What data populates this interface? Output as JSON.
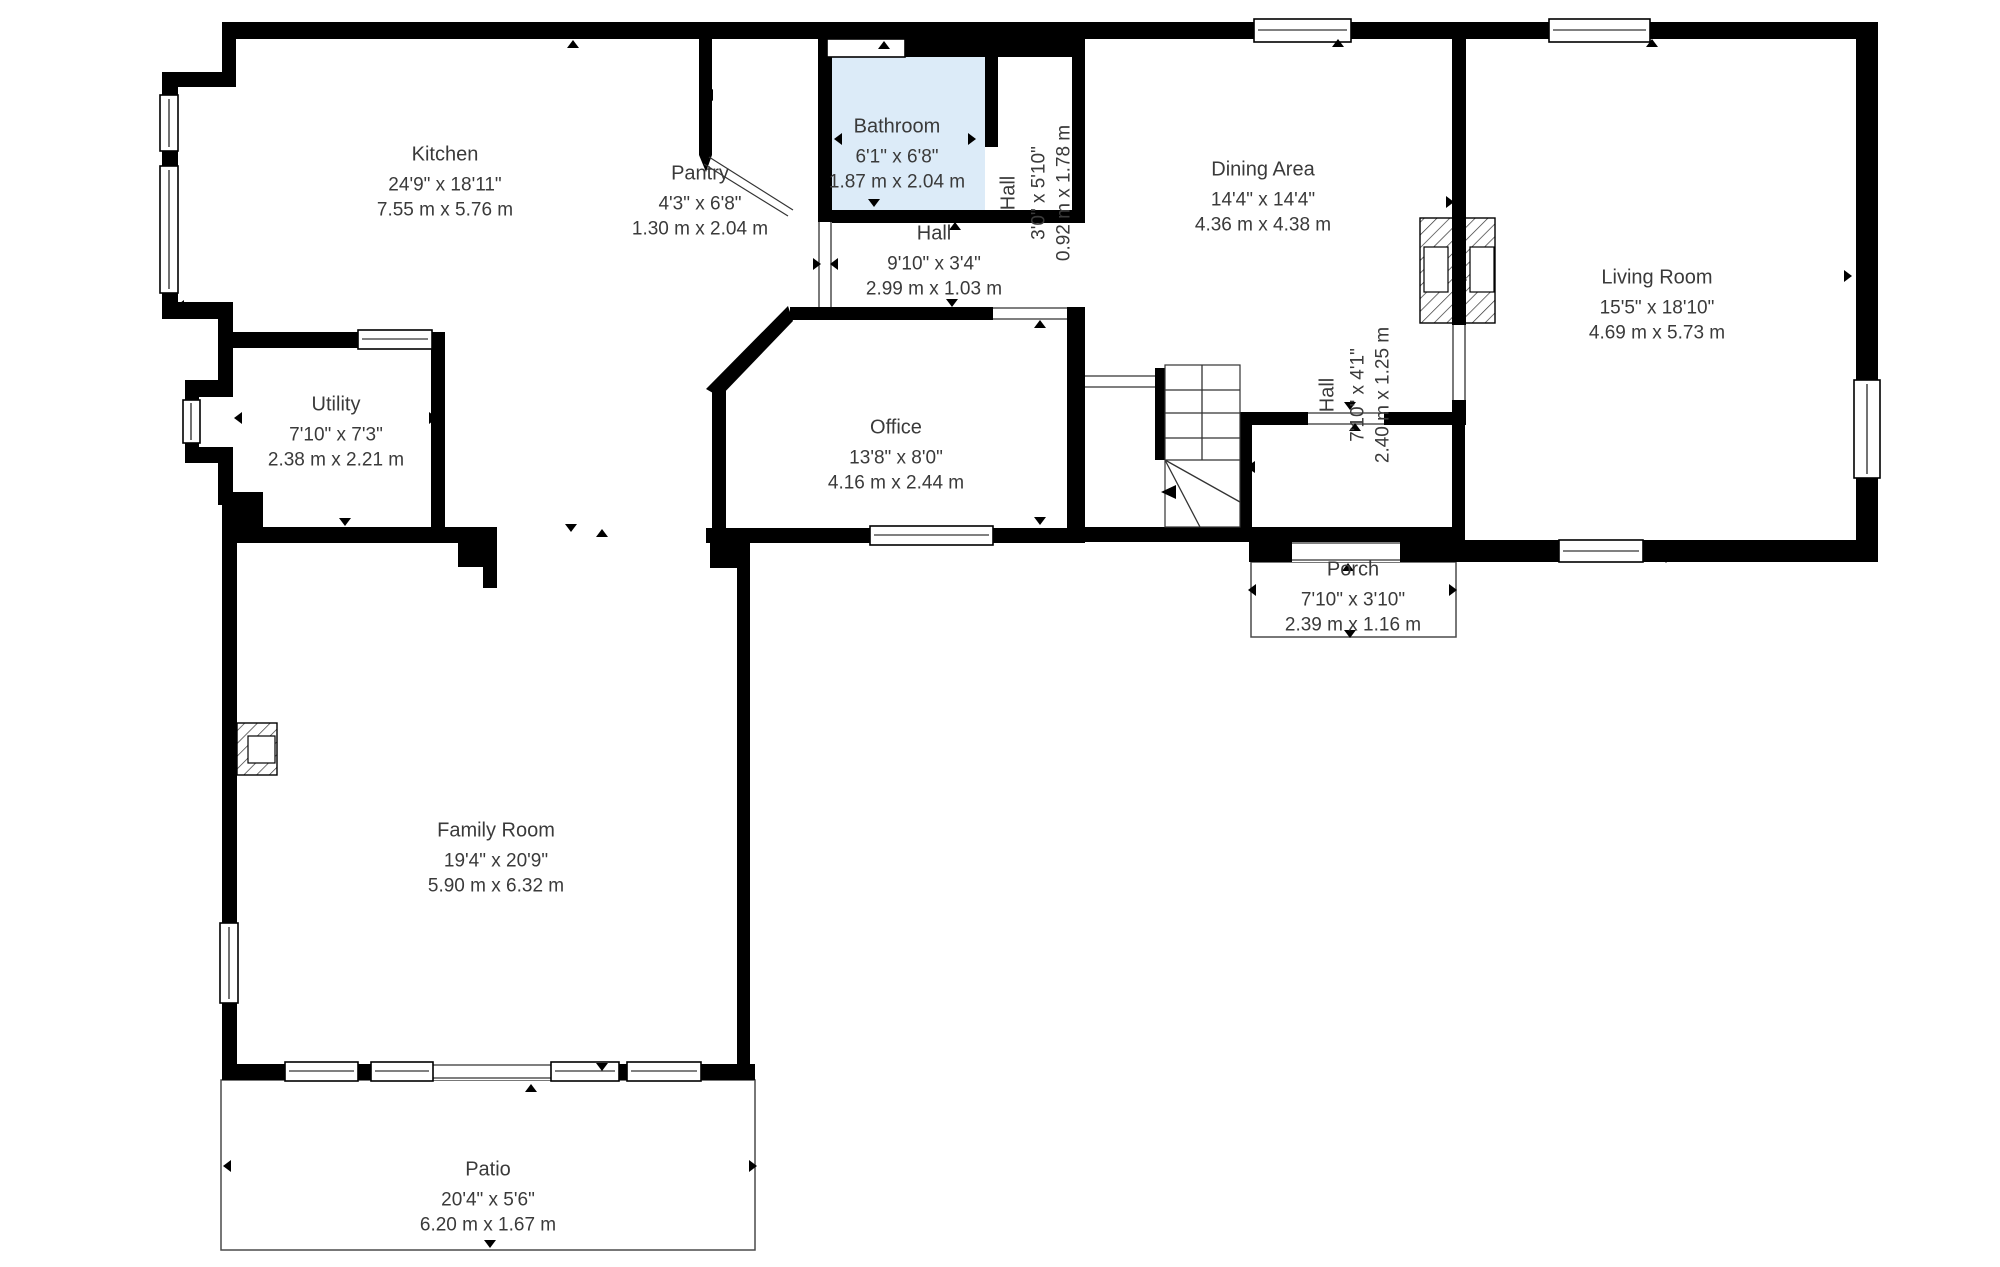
{
  "title": "First floor plan",
  "colors": {
    "wall": "#000000",
    "text": "#3a3a3a",
    "bathroom_fill": "#dcebf8",
    "thin_outline": "#4a4a4a",
    "background": "#ffffff"
  },
  "icons": {
    "door_marker": "small black triangle",
    "window": "white bar with black frame",
    "fireplace": "diagonal-hatched block",
    "staircase": "treads with winders and direction arrow"
  },
  "rooms": [
    {
      "id": "kitchen",
      "name": "Kitchen",
      "imperial": "24'9\" x 18'11\"",
      "metric": "7.55 m x 5.76 m"
    },
    {
      "id": "pantry",
      "name": "Pantry",
      "imperial": "4'3\" x 6'8\"",
      "metric": "1.30 m x 2.04 m"
    },
    {
      "id": "bathroom",
      "name": "Bathroom",
      "imperial": "6'1\" x 6'8\"",
      "metric": "1.87 m x 2.04 m"
    },
    {
      "id": "hall-upper",
      "name": "Hall",
      "imperial": "3'0\" x 5'10\"",
      "metric": "0.92 m x 1.78 m"
    },
    {
      "id": "dining-area",
      "name": "Dining Area",
      "imperial": "14'4\" x 14'4\"",
      "metric": "4.36 m x 4.38 m"
    },
    {
      "id": "living-room",
      "name": "Living Room",
      "imperial": "15'5\" x 18'10\"",
      "metric": "4.69 m x 5.73 m"
    },
    {
      "id": "utility",
      "name": "Utility",
      "imperial": "7'10\" x 7'3\"",
      "metric": "2.38 m x 2.21 m"
    },
    {
      "id": "office",
      "name": "Office",
      "imperial": "13'8\" x 8'0\"",
      "metric": "4.16 m x 2.44 m"
    },
    {
      "id": "hall-middle",
      "name": "Hall",
      "imperial": "9'10\" x 3'4\"",
      "metric": "2.99 m x 1.03 m"
    },
    {
      "id": "hall-stairs",
      "name": "Hall",
      "imperial": "7'10\" x 4'1\"",
      "metric": "2.40 m x 1.25 m"
    },
    {
      "id": "porch",
      "name": "Porch",
      "imperial": "7'10\" x 3'10\"",
      "metric": "2.39 m x 1.16 m"
    },
    {
      "id": "family-room",
      "name": "Family Room",
      "imperial": "19'4\" x 20'9\"",
      "metric": "5.90 m x 6.32 m"
    },
    {
      "id": "patio",
      "name": "Patio",
      "imperial": "20'4\" x 5'6\"",
      "metric": "6.20 m x 1.67 m"
    }
  ]
}
